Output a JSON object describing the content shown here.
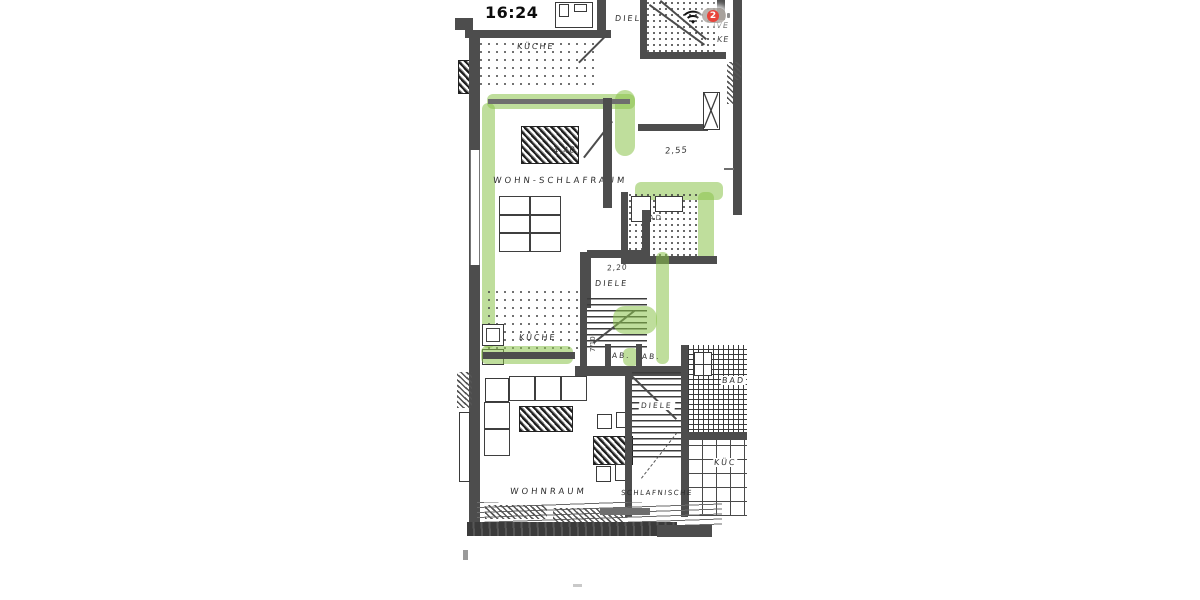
{
  "status_bar": {
    "time": "16:24",
    "battery_badge": "2"
  },
  "colors": {
    "highlight_green": "#8bc34a",
    "wall_gray": "#4d4d4d",
    "battery_badge_red": "#e8443a"
  },
  "plan": {
    "upper": {
      "kueche": "KÜCHE",
      "diele": "DIELE",
      "margin_note_1": "IVE",
      "margin_note_2": "KE"
    },
    "main": {
      "wohn_schlafraum": "WOHN-SCHLAFRAUM",
      "dim_room": "4,40",
      "dim_side": "2,55",
      "bad": "BAD",
      "diele": "DIELE",
      "dim_diele": "2,20",
      "kueche": "KÜCHE",
      "stair_note": "7/10",
      "ab1": "AB.",
      "ab2": "AB."
    },
    "lower": {
      "wohnraum": "WOHNRAUM",
      "diele": "DIELE",
      "bad": "BAD",
      "kueche": "KÜC",
      "schlafnische": "SCHLAFNISCHE"
    }
  }
}
